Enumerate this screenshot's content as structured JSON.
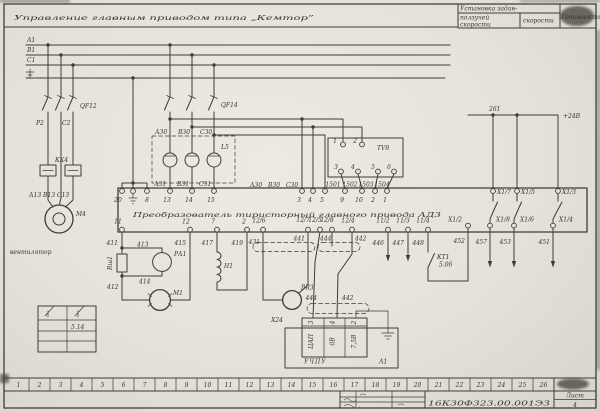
{
  "title": "Управление  главным  приводом  типа „Кемтор”",
  "corner_table": {
    "header": "Установка задан-",
    "col1_line1": "ползучей",
    "col1_line2": "скорости",
    "col2": "скорости",
    "col3": "Готовность"
  },
  "buses": {
    "a1": "А1",
    "b1": "В1",
    "c1": "С1"
  },
  "components": {
    "qf12": "QF12",
    "qf14": "QF14",
    "kk4": "КК4",
    "l5": "L5",
    "tv8": "ТV8",
    "m4": "М4",
    "fan": "вентилятор",
    "pa1": "РА1",
    "m1": "М1",
    "h1": "Н1",
    "rsh1": "Rш1",
    "br3": "ВR3",
    "kt1_name": "КТ1",
    "kt1_pos": "5.06",
    "uchpu": "УЧПУ",
    "a1_unit": "А1",
    "x24": "Х24",
    "dac": "ЦАП",
    "v0": "0В",
    "v75": "7,5В",
    "legend_ref": "5.14"
  },
  "converter": {
    "name": "Преобразователь  тиристорный  главного  привода АД3"
  },
  "terminals": {
    "t20": "20",
    "t8": "8",
    "t13": "13",
    "t14": "14",
    "t15": "15",
    "t3": "3",
    "t4": "4",
    "t5": "5",
    "t9": "9",
    "t10": "10",
    "t2": "2",
    "t1": "1",
    "b11": "11",
    "b12": "12",
    "b7": "7",
    "b2": "2",
    "t126": "12/6",
    "t127": "12/7",
    "t125": "12/5",
    "t128": "12/8",
    "t124": "12/4",
    "t112": "11/2",
    "t113": "11/3",
    "t114": "11/4",
    "x17": "Х1/7",
    "x15": "Х1/5",
    "x13": "Х1/3",
    "x18": "Х1/8",
    "x16": "Х1/6",
    "x14": "Х1/4",
    "x12": "Х1/2",
    "tv1": "1",
    "tv2": "2",
    "tv3": "3",
    "tv4": "4",
    "tv5": "5",
    "tv6": "6",
    "pin3": "3",
    "pin4": "4",
    "pin2": "2"
  },
  "wires": {
    "p2": "Р2",
    "c2": "С2",
    "a13": "А13",
    "b13": "В13",
    "c13": "С13",
    "a30": "А30",
    "b30": "В30",
    "c30": "С30",
    "a31": "А31",
    "b31": "В31",
    "c31": "С31",
    "w1501": "1501",
    "w1502": "1502",
    "w1503": "1503",
    "w1504": "1504",
    "w411": "411",
    "w412": "412",
    "w413": "413",
    "w414": "414",
    "w415": "415",
    "w417": "417",
    "w419": "419",
    "w431": "431",
    "w441": "441",
    "w444": "444",
    "w442": "442",
    "w446": "446",
    "w447": "447",
    "w448": "448",
    "w451": "451",
    "w452": "452",
    "w453": "453",
    "w457": "457",
    "bus261": "261",
    "plus24": "+24В"
  },
  "title_block": {
    "doc_number": "16К30Ф323.00.001Э3",
    "sheet_label": "Лист",
    "sheet_number": "4"
  },
  "ruler": [
    "1",
    "2",
    "3",
    "4",
    "5",
    "6",
    "7",
    "8",
    "9",
    "10",
    "11",
    "12",
    "13",
    "14",
    "15",
    "16",
    "17",
    "18",
    "19",
    "20",
    "21",
    "22",
    "23",
    "24",
    "25",
    "26"
  ]
}
